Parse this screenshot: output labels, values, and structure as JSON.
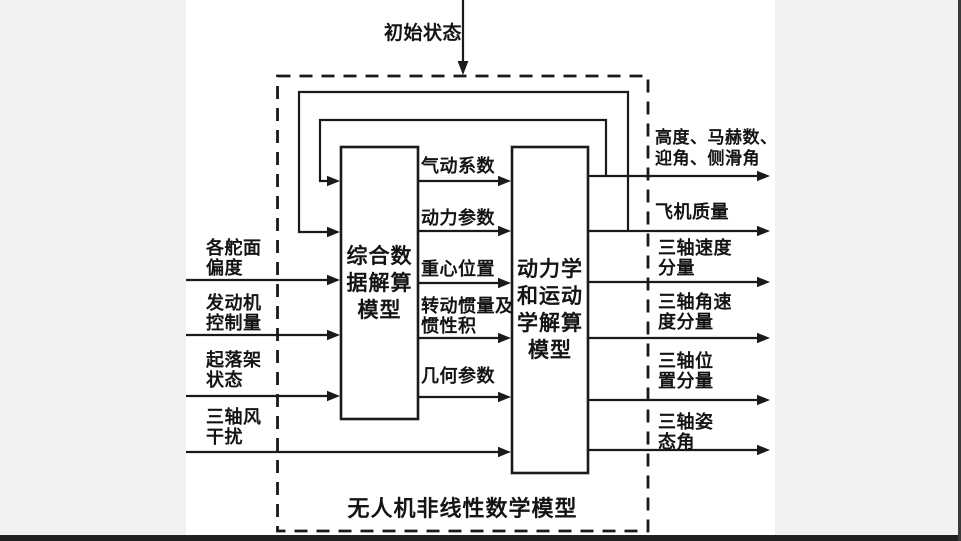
{
  "diagram": {
    "initial_state_label": "初始状态",
    "caption": "无人机非线性数学模型",
    "boxes": [
      {
        "id": "data-solver",
        "label": "综合数\n据解算\n模型"
      },
      {
        "id": "dynamics-solver",
        "label": "动力学\n和运动\n学解算\n模型"
      }
    ],
    "inputs": [
      {
        "label": "各舵面\n偏度"
      },
      {
        "label": "发动机\n控制量"
      },
      {
        "label": "起落架\n状态"
      },
      {
        "label": "三轴风\n干扰"
      }
    ],
    "intermediate": [
      {
        "label": "气动系数"
      },
      {
        "label": "动力参数"
      },
      {
        "label": "重心位置"
      },
      {
        "label": "转动惯量及\n惯性积"
      },
      {
        "label": "几何参数"
      }
    ],
    "outputs": [
      {
        "label": "高度、马赫数、\n迎角、侧滑角"
      },
      {
        "label": "飞机质量"
      },
      {
        "label": "三轴速度\n分量"
      },
      {
        "label": "三轴角速\n度分量"
      },
      {
        "label": "三轴位\n置分量"
      },
      {
        "label": "三轴姿\n态角"
      }
    ],
    "colors": {
      "background": "#f1f1f1",
      "paper": "#ffffff",
      "line": "#1a1a1a",
      "bottom_bar": "#212121"
    }
  }
}
